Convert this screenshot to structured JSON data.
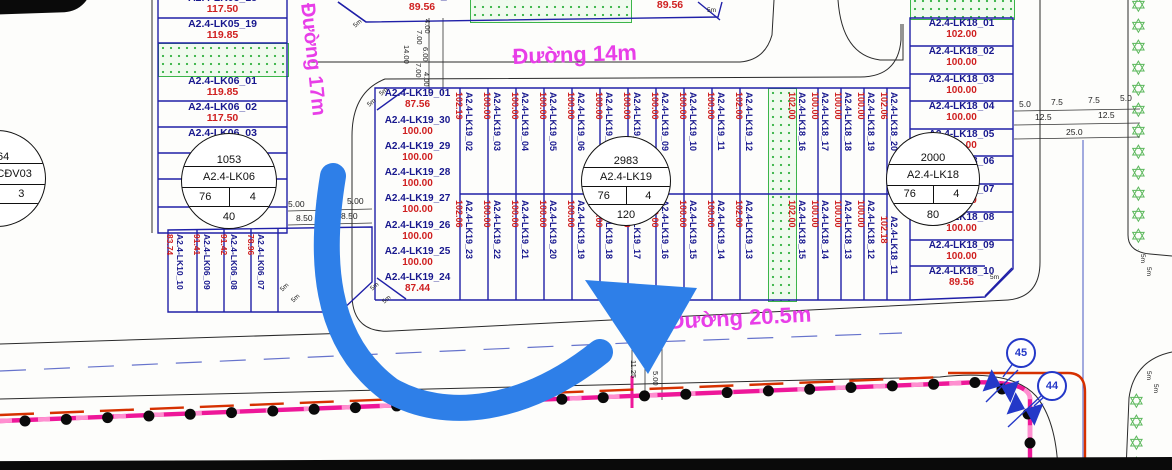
{
  "roads": {
    "d14": "Đường 14m",
    "d17": "Đường 17m",
    "d205": "Đường 20.5m"
  },
  "marker_label": "5m",
  "colors": {
    "lot_border": "#2020a8",
    "label_text": "#18188e",
    "area_text": "#cf1f1f",
    "road_label": "#e83ee8",
    "green": "#3cb54a",
    "pink_line": "#ee1799",
    "red_line": "#d63000",
    "arrow": "#2e7fe8",
    "callout": "#2438c8",
    "tree": "#5cb85c"
  },
  "blocks": {
    "north": {
      "lots": [
        {
          "label": "A2.4-LK15_08",
          "area": "89.56"
        },
        {
          "label": "",
          "area": "89.56"
        }
      ]
    },
    "nw": {
      "lots": [
        {
          "label": "A2.4-LK05_18",
          "area": "117.50"
        },
        {
          "label": "A2.4-LK05_19",
          "area": "119.85"
        },
        {
          "label": "A2.4-LK06_01",
          "area": "119.85"
        },
        {
          "label": "A2.4-LK06_02",
          "area": "117.50"
        },
        {
          "label": "A2.4-LK06_03",
          "area": "117.50"
        },
        {
          "label": "",
          "area": ""
        },
        {
          "label": "",
          "area": ""
        },
        {
          "label": "",
          "area": "117.50"
        }
      ],
      "fragments": {
        "lot04": "04",
        "lot06": "06"
      },
      "stamp": {
        "id": "1053",
        "name": "A2.4-LK06",
        "left": "76",
        "right": "4",
        "bottom": "40"
      }
    },
    "sw": {
      "lots": [
        {
          "label": "A2.4-LK10_10",
          "area": "83.74"
        },
        {
          "label": "A2.4-LK06_09",
          "area": "91.41"
        },
        {
          "label": "A2.4-LK06_08",
          "area": "91.42"
        },
        {
          "label": "A2.4-LK06_07",
          "area": "78.96"
        }
      ]
    },
    "ccdv": {
      "stamp": {
        "id": "5164",
        "name": "A2.4-CCĐV03",
        "left": "0",
        "right": "3",
        "bottom": "-"
      }
    },
    "lk19": {
      "stamp": {
        "id": "2983",
        "name": "A2.4-LK19",
        "left": "76",
        "right": "4",
        "bottom": "120"
      },
      "west_col": [
        {
          "label": "A2.4-LK19_01",
          "area": "87.56"
        },
        {
          "label": "A2.4-LK19_30",
          "area": "100.00"
        },
        {
          "label": "A2.4-LK19_29",
          "area": "100.00"
        },
        {
          "label": "A2.4-LK19_28",
          "area": "100.00"
        },
        {
          "label": "A2.4-LK19_27",
          "area": "100.00"
        },
        {
          "label": "A2.4-LK19_26",
          "area": "100.00"
        },
        {
          "label": "A2.4-LK19_25",
          "area": "100.00"
        },
        {
          "label": "A2.4-LK19_24",
          "area": "87.44"
        }
      ],
      "north_row": [
        {
          "label": "A2.4-LK19_02",
          "area": "102.19"
        },
        {
          "label": "A2.4-LK19_03",
          "area": "100.00"
        },
        {
          "label": "A2.4-LK19_04",
          "area": "100.00"
        },
        {
          "label": "A2.4-LK19_05",
          "area": "100.00"
        },
        {
          "label": "A2.4-LK19_06",
          "area": "100.00"
        },
        {
          "label": "A2.4-LK19_07",
          "area": "100.00"
        },
        {
          "label": "A2.4-LK19_08",
          "area": "100.00"
        },
        {
          "label": "A2.4-LK19_09",
          "area": "100.00"
        },
        {
          "label": "A2.4-LK19_10",
          "area": "100.00"
        },
        {
          "label": "A2.4-LK19_11",
          "area": "100.00"
        },
        {
          "label": "A2.4-LK19_12",
          "area": "102.00"
        }
      ],
      "south_row": [
        {
          "label": "A2.4-LK19_23",
          "area": "102.06"
        },
        {
          "label": "A2.4-LK19_22",
          "area": "100.00"
        },
        {
          "label": "A2.4-LK19_21",
          "area": "100.00"
        },
        {
          "label": "A2.4-LK19_20",
          "area": "100.00"
        },
        {
          "label": "A2.4-LK19_19",
          "area": "100.00"
        },
        {
          "label": "A2.4-LK19_18",
          "area": "100.00"
        },
        {
          "label": "A2.4-LK19_17",
          "area": "100.00"
        },
        {
          "label": "A2.4-LK19_16",
          "area": "100.00"
        },
        {
          "label": "A2.4-LK19_15",
          "area": "100.00"
        },
        {
          "label": "A2.4-LK19_14",
          "area": "100.00"
        },
        {
          "label": "A2.4-LK19_13",
          "area": "102.00"
        }
      ]
    },
    "lk18": {
      "stamp": {
        "id": "2000",
        "name": "A2.4-LK18",
        "left": "76",
        "right": "4",
        "bottom": "80"
      },
      "north_row": [
        {
          "label": "A2.4-LK18_16",
          "area": "102.00"
        },
        {
          "label": "A2.4-LK18_17",
          "area": "100.00"
        },
        {
          "label": "A2.4-LK18_18",
          "area": "100.00"
        },
        {
          "label": "A2.4-LK18_19",
          "area": "100.00"
        },
        {
          "label": "A2.4-LK18_20",
          "area": "102.06"
        }
      ],
      "south_row": [
        {
          "label": "A2.4-LK18_15",
          "area": "102.00"
        },
        {
          "label": "A2.4-LK18_14",
          "area": "100.00"
        },
        {
          "label": "A2.4-LK18_13",
          "area": "100.00"
        },
        {
          "label": "A2.4-LK18_12",
          "area": "100.00"
        },
        {
          "label": "A2.4-LK18_11",
          "area": "102.18"
        }
      ],
      "east_col": [
        {
          "label": "A2.4-LK18_01",
          "area": "102.00"
        },
        {
          "label": "A2.4-LK18_02",
          "area": "100.00"
        },
        {
          "label": "A2.4-LK18_03",
          "area": "100.00"
        },
        {
          "label": "A2.4-LK18_04",
          "area": "100.00"
        },
        {
          "label": "A2.4-LK18_05",
          "area": "100.00"
        },
        {
          "label": "A2.4-LK18_06",
          "area": "100.00"
        },
        {
          "label": "A2.4-LK18_07",
          "area": "100.00"
        },
        {
          "label": "A2.4-LK18_08",
          "area": "100.00"
        },
        {
          "label": "A2.4-LK18_09",
          "area": "100.00"
        },
        {
          "label": "A2.4-LK18_10",
          "area": "89.56"
        }
      ]
    }
  },
  "dims": {
    "right_cross": {
      "row1": [
        "5.0",
        "7.5",
        "7.5",
        "5.0"
      ],
      "row2": [
        "12.5",
        "12.5"
      ],
      "row3": [
        "25.0"
      ]
    },
    "west_gap": {
      "row1": [
        "5.00",
        "7.50",
        "5.00"
      ],
      "row2": [
        "8.50",
        "8.50"
      ]
    },
    "north_cross": [
      "4.00",
      "7.00",
      "14.00",
      "6.00",
      "7.00",
      "4.00"
    ],
    "south_cross": [
      "2.50",
      "0.50",
      "11.25",
      "5.00"
    ]
  },
  "callouts": [
    "45",
    "44"
  ],
  "icons": [
    "valve-icon",
    "tree-star-icon",
    "pole-dot-icon",
    "arrow-annotation-icon"
  ]
}
